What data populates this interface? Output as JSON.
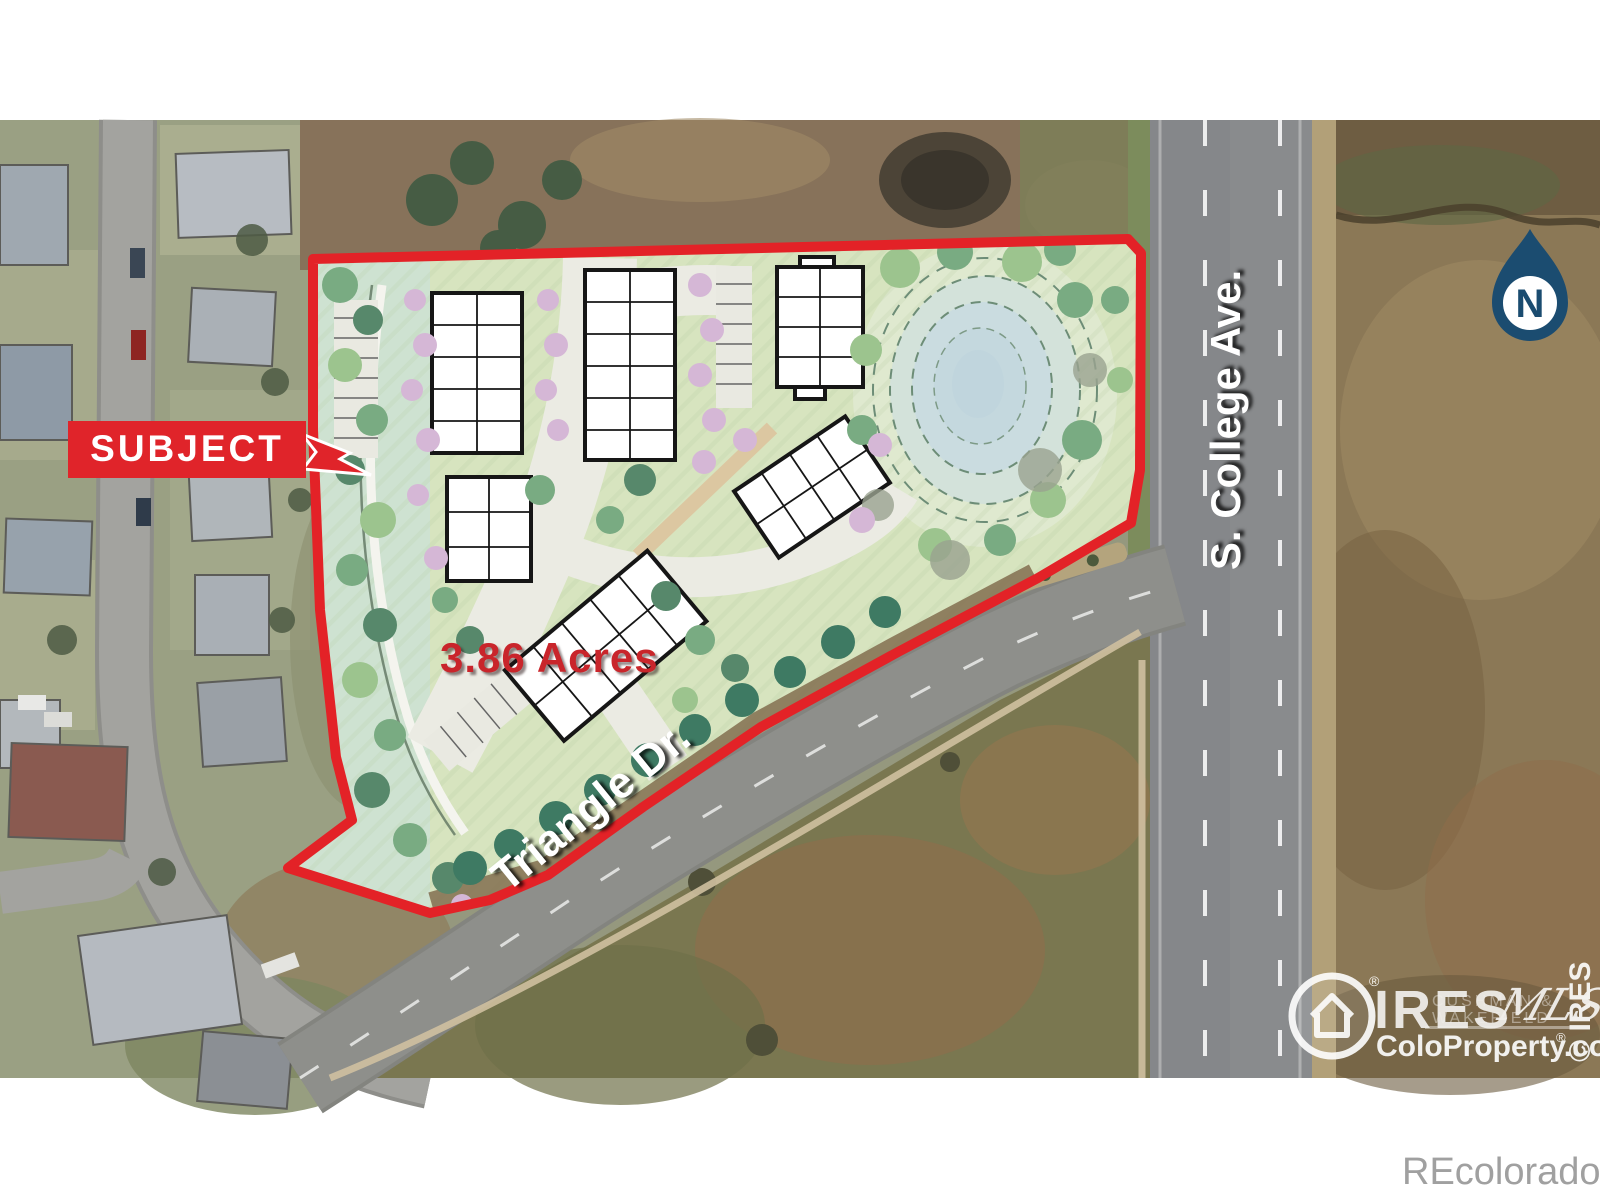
{
  "annotations": {
    "subject": "SUBJECT",
    "acreage": "3.86 Acres",
    "street_triangle": "Triangle Dr.",
    "street_college": "S. College Ave.",
    "north": "N"
  },
  "watermarks": {
    "brand": "IRES",
    "brand_reg": "®",
    "mls": "MLS",
    "cushman_line1": "CUSHMAN &",
    "cushman_line2": "WAKEFIELD",
    "site": "ColoProperty.com",
    "site_reg": "®",
    "copyright_vertical": "© IRES",
    "recolorado": "REcolorado"
  },
  "colors": {
    "boundary_red": "#e32227",
    "label_red": "#e0242a",
    "acres_red": "#c9252b",
    "north_navy": "#1b4c70",
    "recolorado_gray": "#a0a0a0"
  }
}
